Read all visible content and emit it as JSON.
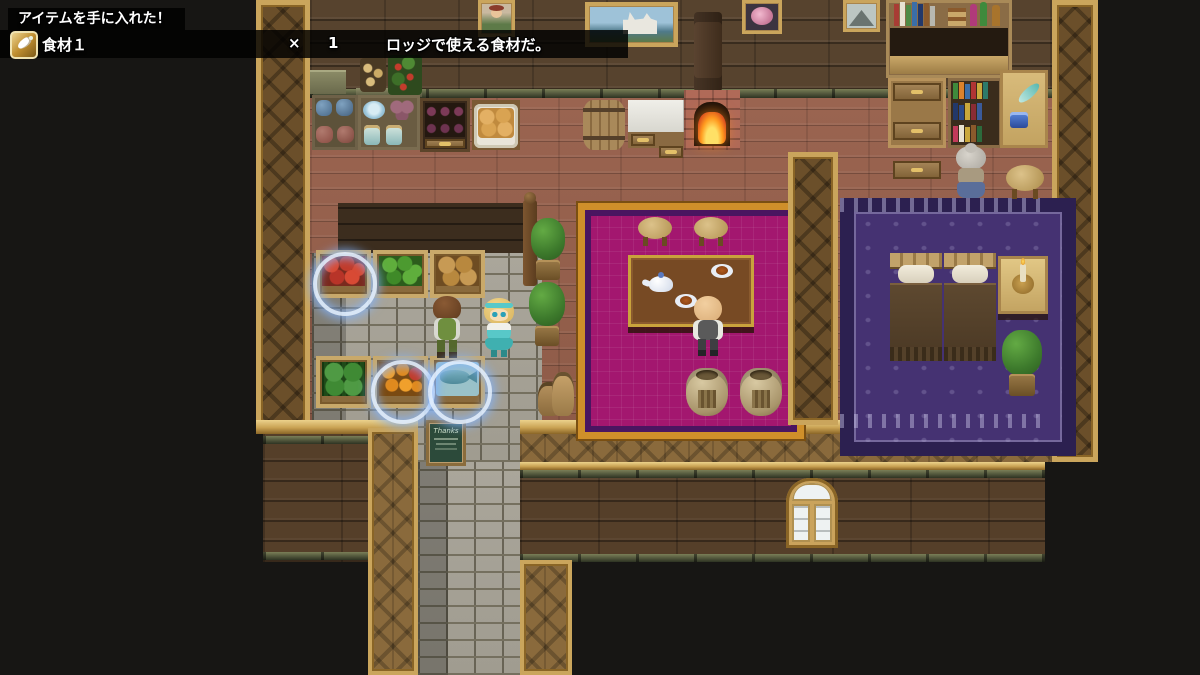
{
  "notification": {
    "title": "アイテムを手に入れた！",
    "item_icon": "radish-icon",
    "item_name": "食材１",
    "times_symbol": "×",
    "quantity": "1",
    "description": "ロッジで使える食材だ。"
  },
  "signs": {
    "chalkboard": "Thanks"
  },
  "scene_objects": [
    "paintings",
    "bookshelves",
    "fireplace",
    "barrel",
    "bread-basket",
    "wine-rack",
    "produce-stands-tomato-lettuce-potato-watermelon-orange-fish",
    "sparkle-event-rings",
    "dining-table-with-tea-set",
    "stools",
    "twin-beds",
    "nightstand-candle",
    "potted-plants",
    "grain-sacks",
    "npc-boy",
    "npc-girl",
    "npc-bald-man",
    "npc-old-lady"
  ],
  "colors": {
    "overlay_bg": "#000000",
    "notification_text": "#ffffff",
    "item_icon_gold": "#bf8e30",
    "floor_wood": "#96604e",
    "wall_wood": "#57432e",
    "frame_gold": "#caa55c",
    "trim_green": "#5c6140",
    "rug_pink": "#a3176f",
    "rug_purple": "#453272",
    "sparkle_blue": "#9cc4ff",
    "fire_orange": "#ff8c1a",
    "chalkboard_green": "#2c4a3a"
  }
}
